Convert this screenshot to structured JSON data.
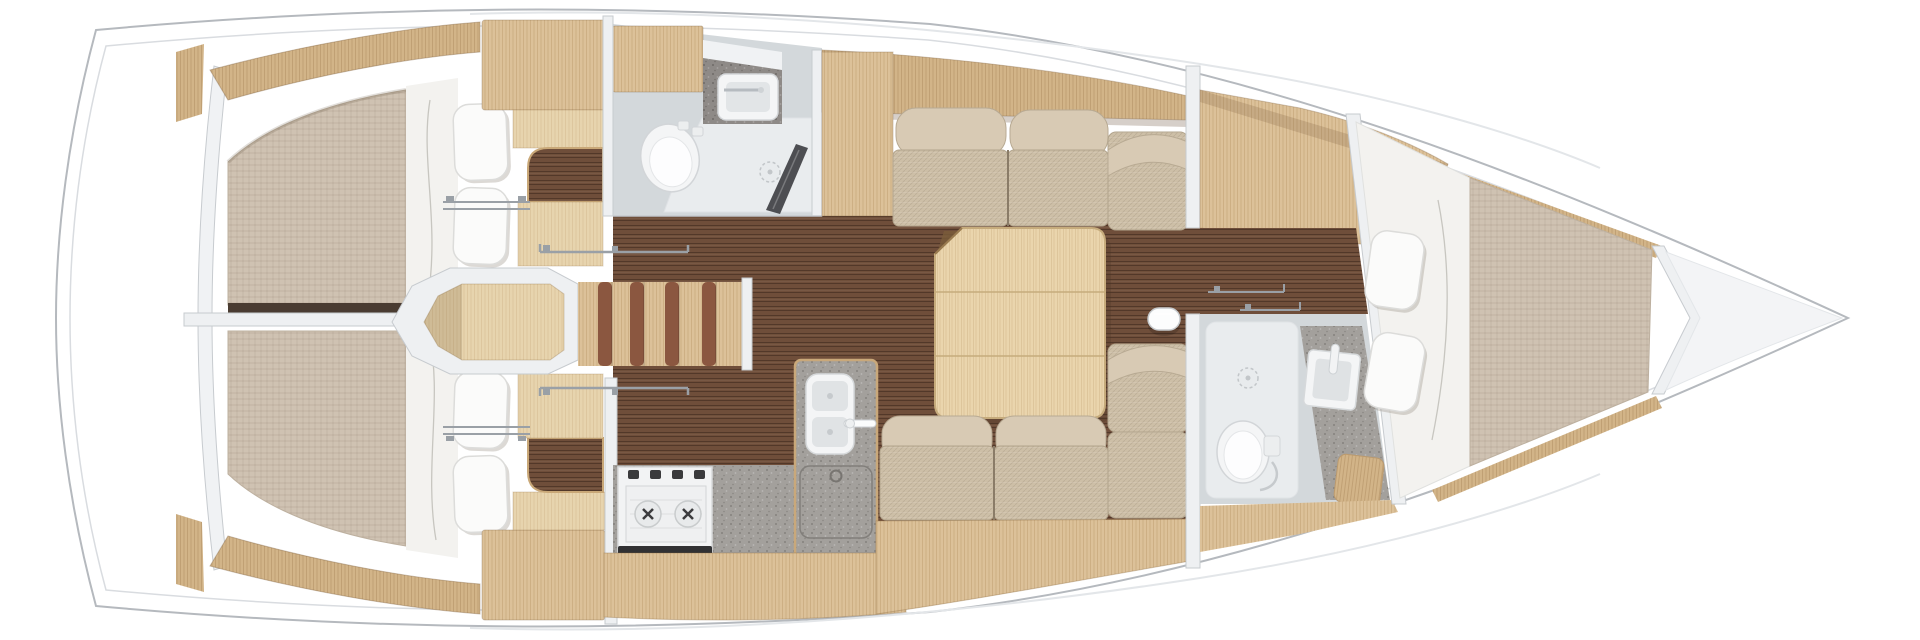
{
  "floorplan": {
    "vessel": "sailing-yacht-interior-floor-plan",
    "view": "top-down",
    "bow_direction": "right",
    "rooms": [
      {
        "id": "aft-cabin-port",
        "features": [
          "double-berth",
          "mattress",
          "duvet",
          "pillows-2",
          "wardrobe",
          "walnut-entry-floor",
          "door-track"
        ]
      },
      {
        "id": "aft-cabin-starboard",
        "features": [
          "double-berth",
          "mattress",
          "duvet",
          "pillows-2",
          "wardrobe",
          "walnut-entry-floor",
          "door-track"
        ]
      },
      {
        "id": "companionway",
        "features": [
          "landing-platform",
          "stairs-5-treads",
          "grab-rail-port",
          "grab-rail-starboard"
        ]
      },
      {
        "id": "aft-head",
        "features": [
          "toilet",
          "vanity-sink",
          "counter",
          "shower-tray",
          "shower-drain",
          "shower-screen"
        ]
      },
      {
        "id": "galley",
        "features": [
          "two-burner-stove",
          "stove-knobs-4",
          "double-sink",
          "faucet",
          "icebox-lid",
          "granite-counters",
          "stowage-band"
        ]
      },
      {
        "id": "salon",
        "features": [
          "u-shaped-sofa",
          "seat-cushions",
          "back-bolsters",
          "folding-table-3-panels",
          "mast-post",
          "walnut-sole"
        ]
      },
      {
        "id": "forward-dressing",
        "features": [
          "wardrobe-cabinet",
          "walnut-sole-strip",
          "towel-rails"
        ]
      },
      {
        "id": "forward-head",
        "features": [
          "toilet",
          "square-sink",
          "faucet",
          "shower-drain",
          "granite-counter",
          "wood-seat"
        ]
      },
      {
        "id": "forward-cabin",
        "features": [
          "v-berth",
          "duvet",
          "pillows-2",
          "mattress",
          "oak-trim-rails"
        ]
      },
      {
        "id": "anchor-locker",
        "features": [
          "bow-stowage"
        ]
      }
    ]
  },
  "palette": {
    "hull_white": "#ffffff",
    "hull_line": "#b5b9be",
    "inner_line": "#d9dce0",
    "deck_line": "#e3e6e9",
    "wall": "#eef0f2",
    "wall_line": "#c7cbcf",
    "divider_dark": "#4a3c32",
    "walnut": "#6f4e3a",
    "oak_light": "#dcc199",
    "oak_mid": "#d2b488",
    "oak_pale": "#e7d4ae",
    "table_oak": "#ead5ad",
    "table_edge": "#c6ab7c",
    "mattress": "#cfc2b2",
    "bedding": "#f3f2ef",
    "pillow": "#fbfbfa",
    "cushion": "#cdbfa7",
    "cushion_light": "#d8cab4",
    "cushion_seam": "#8a7c68",
    "granite": "#a3a09c",
    "granite_dark": "#8e8a87",
    "bath_floor": "#d3d8db",
    "shower_tray": "#e9ecee",
    "fixture_white": "#f4f5f6",
    "fixture_line": "#d2d5d8",
    "stove_white": "#f2f3f4",
    "knob_dark": "#3a3a3c",
    "vent_dark": "#313133",
    "screen_dark": "#3f4044",
    "metal": "#9aa0a6",
    "stair_stripe": "#8b5740"
  }
}
